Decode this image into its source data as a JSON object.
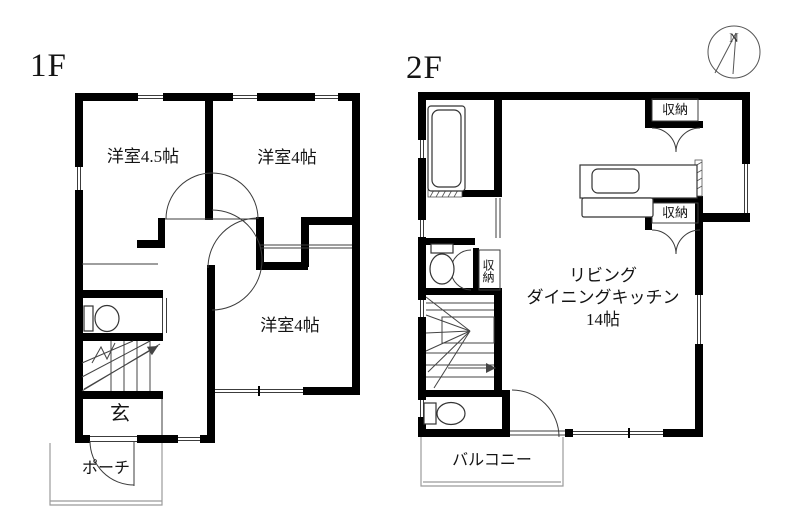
{
  "colors": {
    "wall": "#000000",
    "line": "#3c3c3c",
    "light_line": "#9b9b9b",
    "text": "#141414",
    "background": "#ffffff"
  },
  "floor1": {
    "title": "1F",
    "room_45": "洋室4.5帖",
    "room_4_top": "洋室4帖",
    "room_4_bottom": "洋室4帖",
    "entrance": "玄",
    "porch": "ポーチ"
  },
  "floor2": {
    "title": "2F",
    "ldk_line1": "リビング",
    "ldk_line2": "ダイニングキッチン",
    "ldk_line3": "14帖",
    "storage_top": "収納",
    "storage_mid": "収納",
    "storage_closet": "収納",
    "balcony": "バルコニー"
  },
  "compass": {
    "north": "N"
  }
}
